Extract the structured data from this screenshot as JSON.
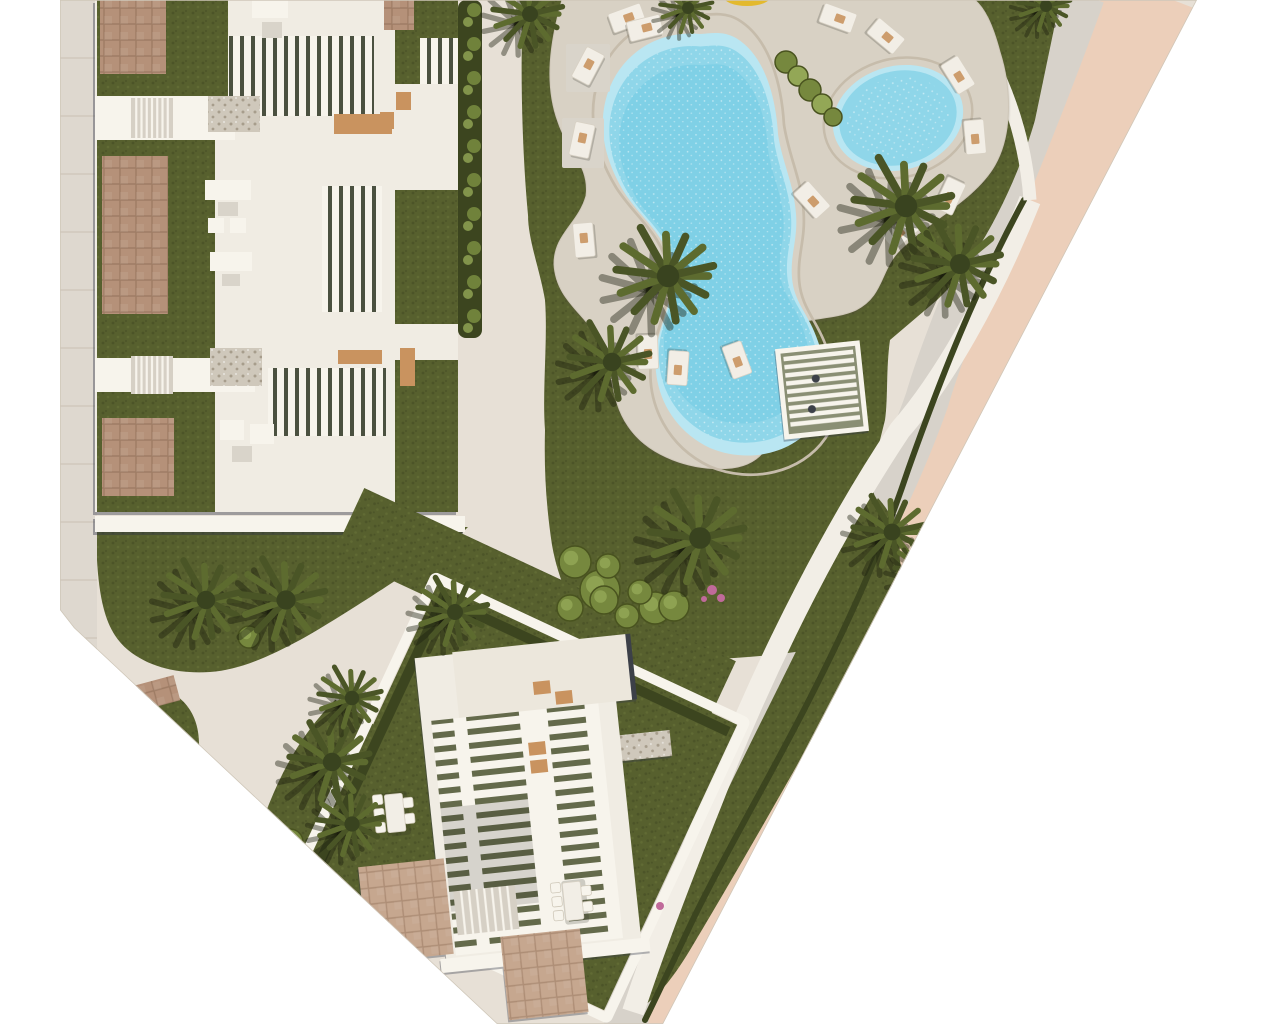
{
  "meta": {
    "description": "Aerial top-down 3D rendered site plan of a residential resort development with apartment blocks, landscaped gardens, palm trees, a free-form swimming pool with a children's pool, sun loungers, a pergola deck and a perimeter road",
    "canvas": {
      "width": 1280,
      "height": 1024
    }
  },
  "palette": {
    "page": "#ffffff",
    "ground": "#e7e0d6",
    "ground_edge": "#cfc7b9",
    "sidewalk_left": "#ded8cf",
    "joint": "#cdc5b9",
    "road_salmon": "#eccfba",
    "road_sidewalk": "#d7d2ca",
    "walk_white": "#f2eee6",
    "hedge_dark": "#3c451f",
    "grass": "#57602e",
    "grass_dark": "#4c5428",
    "grass_light": "#646e36",
    "deck": "#d8d1c4",
    "deck_ring": "#c6bcab",
    "pool_rim": "#b9e6f2",
    "pool_mid": "#8fd6e9",
    "pool_core": "#7fd0e6",
    "bldg_white": "#f0ece3",
    "bright_white": "#f7f4ec",
    "roof_grey": "#ece7dc",
    "brick_a": "#b59179",
    "brick_a_line": "#9e7c64",
    "brick_b": "#c6a78f",
    "brick_b_line": "#ad8d75",
    "gravel": "#cfc8bb",
    "gravel_dot": "#a79d8c",
    "slat_dark": "#4b5140",
    "slat_base_h": "#646a4b",
    "tan_deck": "#c9935f",
    "gray_pad": "#d9d4ca",
    "stair_base": "#d6d0c5",
    "dark_edge": "#3c4048",
    "palm_dark1": "#4a5526",
    "palm_dark2": "#5d6b2f",
    "palm_light1": "#7d9047",
    "palm_light2": "#95a957",
    "palm_core": "#39431f",
    "palm_shadow": "rgba(28,32,15,0.42)",
    "bush_fill": "#76883e",
    "bush_light": "#93a756",
    "bush_edge": "#49531f",
    "flower_pink": "#c06a9a",
    "parasol_yellow": "#e3b92e"
  },
  "scene": {
    "plan_polygon": "60,0 1197,0 663,1024 497,1024 74,628 60,610",
    "left_sidewalk": {
      "x": 60,
      "y": 0,
      "w": 37,
      "h": 660,
      "joints_every": 58
    },
    "road": {
      "salmon_path": "M1152,-8 C1080,180 1000,330 967,400 C900,590 770,770 723,850 C695,900 664,960 649,1030",
      "salmon_width": 90,
      "sidewalk_path": "M1083,-5 C1020,170 950,320 927,400 C860,590 730,760 676,850 C650,900 632,960 626,1026",
      "sidewalk_width": 44,
      "walk_path": "M1030,200 C990,300 942,382 900,430 C840,520 770,650 712,800 C680,880 650,960 633,1012",
      "walk_width": 22,
      "hedge_path": "M1024,200 C975,290 940,380 908,470 C882,548 850,620 806,706 C766,784 716,870 688,930 C670,968 655,1000 645,1020",
      "hedge_width": 6,
      "arc_path": "M950,-6 C1000,60 1025,130 1030,200",
      "arc_width": 13
    },
    "lawns": [
      {
        "name": "left-garden-lawn",
        "d": "M97,527 L468,527 L455,540 C420,565 340,618 300,640 C270,656 240,670 210,672 C180,674 150,668 128,650 C110,635 100,612 97,560 Z"
      },
      {
        "name": "pool-garden-lawn",
        "d": "M523,0 L1060,0 L1035,120 C1018,180 980,260 937,300 L890,340 C886,368 888,400 885,420 L870,480 C878,505 882,530 880,560 C876,592 868,620 855,640 C790,658 700,662 610,660 C580,625 560,590 552,545 C546,505 544,470 545,430 C542,390 548,340 545,300 C540,270 528,240 528,215 C522,150 520,70 523,0 Z"
      },
      {
        "name": "road-side-lawn-lower",
        "d": "M878,498 C898,520 903,545 898,572 C872,640 834,700 800,760 C764,824 720,900 690,950 C672,980 655,1000 640,1008 L628,998 C648,955 662,925 680,888 C712,822 742,760 772,700 C800,644 840,560 878,498 Z"
      },
      {
        "name": "island-teardrop-small",
        "d": "M150,686 C192,692 206,728 196,768 C188,800 176,822 160,834 C148,842 138,836 131,820 C116,790 112,744 122,712 C128,694 138,684 150,686 Z"
      },
      {
        "name": "island-teardrop-large",
        "d": "M335,700 C375,716 397,746 398,782 C399,816 380,850 340,872 C310,886 280,890 262,878 C250,870 248,854 256,838 C272,796 288,748 335,700 Z"
      },
      {
        "name": "lawn-wedge-south",
        "d": "M330,922 L378,938 L362,1016 L326,1000 Z"
      }
    ],
    "deck": {
      "d": "M562,0 C550,42 544,84 558,122 C568,152 590,166 586,196 C578,224 554,234 554,264 C556,302 588,314 602,346 C614,372 610,400 628,426 C648,456 692,472 732,468 C764,464 776,440 776,408 C776,376 764,356 776,336 C788,316 830,322 856,310 C884,296 880,270 900,250 C930,220 975,200 995,165 C1012,135 1012,90 1000,52 C992,22 984,8 975,0 Z"
    },
    "pool_big": {
      "d": "M700,34 C660,30 622,52 608,92 C596,128 606,162 624,192 C642,220 666,234 672,268 C676,298 660,320 656,352 C652,392 672,430 710,448 C748,464 794,454 816,422 C834,394 826,362 816,336 C808,314 794,302 792,278 C790,254 798,240 796,214 C794,184 782,162 778,134 C776,100 766,56 736,38 C724,31 712,33 700,34 Z",
      "cx": 712,
      "cy": 242,
      "ring_scale": 1.09,
      "mid_scale": 0.94,
      "core_scale": 0.85
    },
    "pool_small": {
      "cx": 898,
      "cy": 118,
      "rx": 66,
      "ry": 52,
      "rot": -15,
      "ring_scale": 1.14,
      "mid_scale": 0.9,
      "core_scale": 0.78
    },
    "parasol": {
      "cx": 747,
      "cy": -4,
      "rx": 24,
      "ry": 10
    },
    "pergola": {
      "x": 822,
      "y": 390,
      "w": 80,
      "h": 86,
      "rot": -6,
      "slats": 9
    },
    "lounger_pads": [
      [
        566,
        44,
        44,
        48
      ],
      [
        562,
        118,
        42,
        50
      ]
    ],
    "loungers": [
      [
        627,
        18,
        -20
      ],
      [
        645,
        28,
        -14
      ],
      [
        588,
        66,
        -62
      ],
      [
        582,
        140,
        -78
      ],
      [
        584,
        240,
        -95
      ],
      [
        648,
        352,
        88
      ],
      [
        678,
        368,
        94
      ],
      [
        737,
        360,
        70
      ],
      [
        812,
        200,
        48
      ],
      [
        838,
        18,
        20
      ],
      [
        886,
        36,
        40
      ],
      [
        958,
        75,
        58
      ],
      [
        975,
        137,
        85
      ],
      [
        950,
        196,
        115
      ],
      [
        901,
        232,
        140
      ]
    ],
    "bush_chain": [
      [
        786,
        62,
        11
      ],
      [
        798,
        76,
        10
      ],
      [
        810,
        90,
        11
      ],
      [
        822,
        104,
        10
      ],
      [
        833,
        117,
        9
      ]
    ],
    "bushes": [
      [
        575,
        562,
        16
      ],
      [
        600,
        590,
        20
      ],
      [
        570,
        608,
        13
      ],
      [
        627,
        616,
        12
      ],
      [
        655,
        608,
        16
      ],
      [
        608,
        566,
        12
      ],
      [
        604,
        600,
        14
      ],
      [
        640,
        592,
        12
      ],
      [
        674,
        606,
        15
      ],
      [
        290,
        842,
        13
      ],
      [
        249,
        637,
        11
      ]
    ],
    "flowers": [
      [
        712,
        590,
        5
      ],
      [
        721,
        598,
        4
      ],
      [
        704,
        599,
        3
      ],
      [
        660,
        906,
        4
      ]
    ],
    "palms": [
      [
        530,
        14,
        40,
        0
      ],
      [
        688,
        8,
        30,
        0
      ],
      [
        668,
        276,
        56,
        0
      ],
      [
        612,
        362,
        46,
        0
      ],
      [
        906,
        206,
        56,
        0
      ],
      [
        960,
        264,
        50,
        0
      ],
      [
        700,
        538,
        54,
        0
      ],
      [
        1046,
        6,
        30,
        0
      ],
      [
        892,
        532,
        42,
        0
      ],
      [
        928,
        572,
        36,
        0
      ],
      [
        206,
        600,
        46,
        0
      ],
      [
        286,
        600,
        48,
        0
      ],
      [
        162,
        758,
        40,
        1
      ],
      [
        332,
        762,
        46,
        0
      ],
      [
        352,
        824,
        38,
        0
      ],
      [
        455,
        612,
        40,
        0
      ],
      [
        352,
        698,
        36,
        0
      ]
    ],
    "hedge_strip": {
      "x": 458,
      "y": 0,
      "w": 24,
      "h": 338,
      "bush_step": 34
    },
    "island_brick": [
      133,
      686,
      42,
      26,
      -15
    ],
    "block_a": {
      "items": [
        [
          95,
          0,
          363,
          512,
          "w"
        ],
        [
          97,
          0,
          69,
          512,
          "g"
        ],
        [
          166,
          0,
          49,
          512,
          "g"
        ],
        [
          215,
          0,
          180,
          512,
          "w"
        ],
        [
          395,
          0,
          63,
          512,
          "g"
        ],
        [
          187,
          0,
          41,
          116,
          "g"
        ],
        [
          100,
          0,
          66,
          74,
          "b"
        ],
        [
          102,
          156,
          66,
          158,
          "b"
        ],
        [
          102,
          418,
          72,
          78,
          "b"
        ],
        [
          95,
          96,
          140,
          44,
          "W"
        ],
        [
          95,
          358,
          160,
          34,
          "W"
        ],
        [
          228,
          36,
          146,
          80,
          "s"
        ],
        [
          420,
          38,
          38,
          78,
          "s"
        ],
        [
          322,
          186,
          60,
          126,
          "s"
        ],
        [
          268,
          368,
          118,
          68,
          "s"
        ],
        [
          384,
          0,
          30,
          30,
          "b"
        ],
        [
          394,
          84,
          64,
          106,
          "w"
        ],
        [
          394,
          324,
          64,
          36,
          "w"
        ],
        [
          334,
          114,
          58,
          20,
          "t"
        ],
        [
          338,
          350,
          44,
          14,
          "t"
        ],
        [
          400,
          348,
          15,
          38,
          "t"
        ],
        [
          396,
          92,
          15,
          18,
          "t"
        ],
        [
          380,
          112,
          14,
          17,
          "t"
        ],
        [
          252,
          0,
          36,
          18,
          "W"
        ],
        [
          262,
          22,
          20,
          16,
          "p"
        ],
        [
          208,
          96,
          52,
          36,
          "v"
        ],
        [
          210,
          348,
          52,
          38,
          "v"
        ],
        [
          205,
          180,
          46,
          20,
          "W"
        ],
        [
          218,
          202,
          20,
          14,
          "p"
        ],
        [
          208,
          218,
          16,
          15,
          "W"
        ],
        [
          230,
          218,
          16,
          15,
          "W"
        ],
        [
          210,
          252,
          42,
          19,
          "W"
        ],
        [
          222,
          274,
          18,
          12,
          "p"
        ],
        [
          220,
          420,
          24,
          20,
          "W"
        ],
        [
          250,
          424,
          24,
          20,
          "W"
        ],
        [
          232,
          446,
          20,
          16,
          "p"
        ],
        [
          95,
          516,
          370,
          16,
          "W"
        ]
      ],
      "stairs": [
        [
          131,
          98,
          42,
          40,
          8
        ],
        [
          131,
          356,
          42,
          38,
          8
        ]
      ]
    },
    "block_b": {
      "plot_rot": 25,
      "plot_cx": 520,
      "plot_cy": 800,
      "plot_items": [
        [
          247,
          583,
          410,
          72,
          "g"
        ],
        [
          355,
          640,
          330,
          315,
          "g"
        ]
      ],
      "plot_frame": [
        349,
        634,
        342,
        327
      ],
      "plot_hedges": [
        [
          360,
          645,
          10,
          305
        ],
        [
          360,
          645,
          320,
          10
        ]
      ],
      "bldg_rot": -6,
      "bldg_cx": 520,
      "bldg_cy": 800,
      "bldg_items": [
        [
          430,
          650,
          54,
          26,
          "v"
        ],
        [
          612,
          746,
          64,
          26,
          "v"
        ],
        [
          430,
          648,
          196,
          310,
          "w"
        ],
        [
          468,
          646,
          178,
          66,
          "w2"
        ],
        [
          642,
          646,
          5,
          66,
          "d"
        ],
        [
          440,
          712,
          168,
          236,
          "S"
        ],
        [
          528,
          712,
          28,
          236,
          "W"
        ],
        [
          462,
          712,
          13,
          236,
          "W"
        ],
        [
          594,
          712,
          14,
          236,
          "W"
        ],
        [
          440,
          800,
          88,
          104,
          "o"
        ],
        [
          545,
          684,
          17,
          13,
          "t"
        ],
        [
          566,
          696,
          17,
          13,
          "t"
        ],
        [
          534,
          744,
          17,
          13,
          "t"
        ],
        [
          534,
          762,
          17,
          13,
          "t"
        ],
        [
          424,
          950,
          210,
          14,
          "W"
        ],
        [
          352,
          850,
          86,
          96,
          "B"
        ],
        [
          486,
          934,
          80,
          84,
          "B"
        ]
      ],
      "bldg_stairs": [
        [
          444,
          884,
          62,
          44,
          8
        ]
      ],
      "dining_sets": [
        [
          395,
          812,
          -6
        ],
        [
          573,
          900,
          -6
        ]
      ]
    }
  }
}
